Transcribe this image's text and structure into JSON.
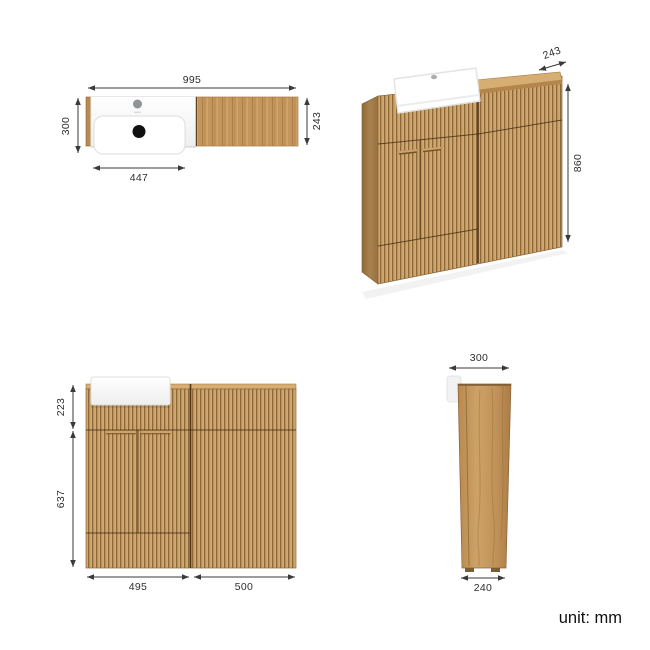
{
  "figure": {
    "unit_note": "unit: mm",
    "description": "bathroom vanity and WC unit dimension drawing"
  },
  "dims": {
    "plan": {
      "width": "995",
      "depth_total": "300",
      "basin_width": "447",
      "depth_cabinet": "243"
    },
    "perspective": {
      "depth": "243",
      "height": "860"
    },
    "front": {
      "upper": "223",
      "lower": "637",
      "vanity_width": "495",
      "wc_width": "500"
    },
    "side": {
      "depth_top": "300",
      "depth_base": "240"
    }
  },
  "colors": {
    "wood": "#c79d63",
    "wood_groove": "#8d6838",
    "wood_highlight": "#dab57e",
    "counter": "#d6ad72",
    "basin_white": "#ffffff",
    "dim_line": "#3a3a3a",
    "background": "#ffffff"
  }
}
